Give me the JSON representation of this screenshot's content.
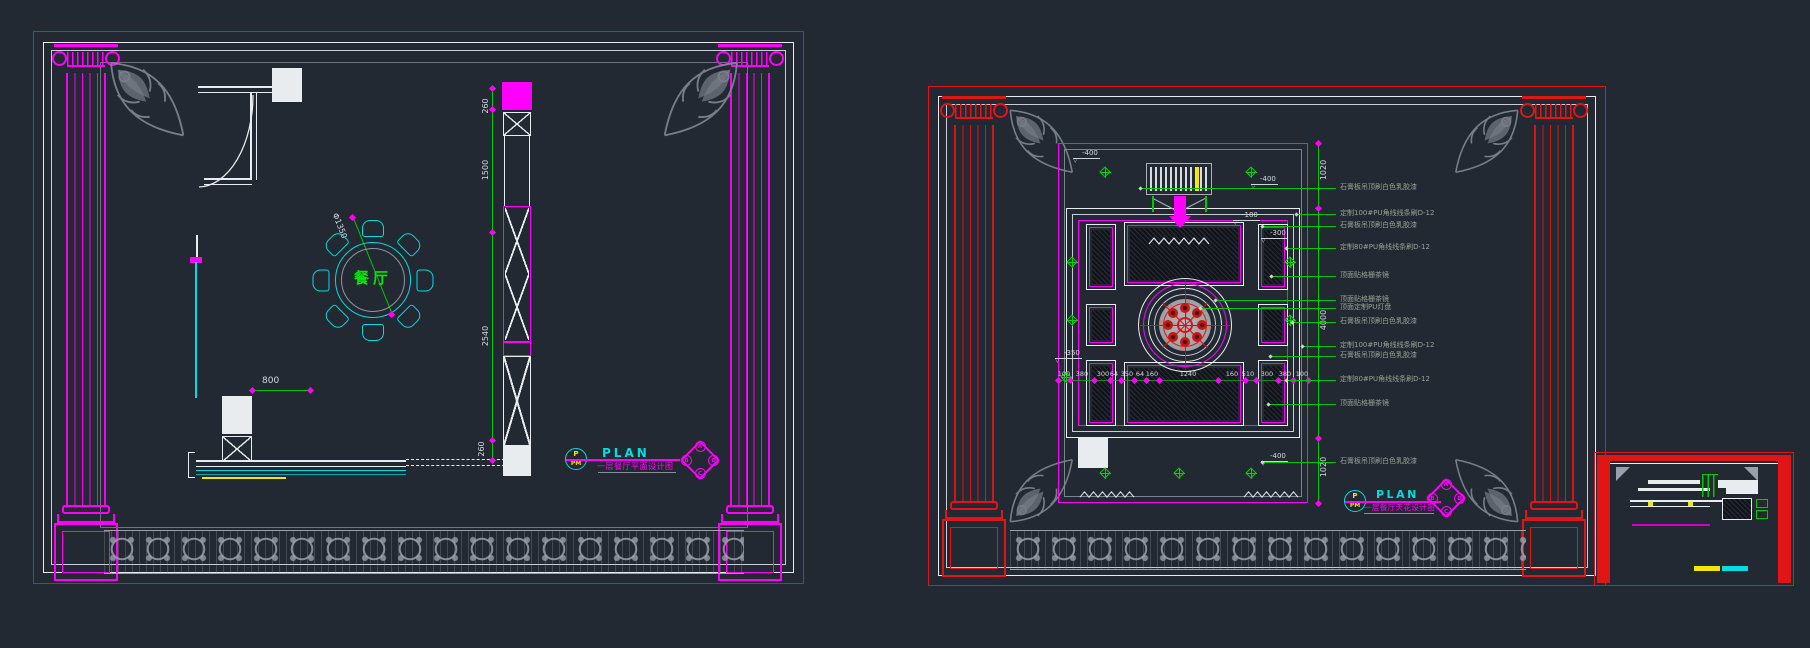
{
  "app": {
    "background": "#232932"
  },
  "colors": {
    "red": "#e01515",
    "magenta": "#ff00ff",
    "cyan": "#00dde0",
    "green": "#00c800",
    "yellow": "#f2e700",
    "white": "#e9ecef",
    "gray": "#98a0ab",
    "annotation_green": "#9aa394"
  },
  "floor_plan": {
    "title": "PLAN",
    "subtitle": "一层餐厅平面设计图",
    "stamp": {
      "top": "P",
      "bottom": "PM"
    },
    "room_label": "餐厅",
    "table_diameter": "Φ1350",
    "door_dim": "800",
    "vertical_dims": [
      "260",
      "1500",
      "2540",
      "260"
    ],
    "logo": {
      "top": "A",
      "left": "B",
      "right": "D",
      "bottom": "C"
    }
  },
  "ceiling_plan": {
    "title": "PLAN",
    "subtitle": "一层餐厅天花设计图",
    "stamp": {
      "top": "P",
      "bottom": "PM"
    },
    "vertical_dims": [
      "1020",
      "4000",
      "1020"
    ],
    "bottom_dims": [
      "100",
      "380",
      "300",
      "64",
      "350",
      "64",
      "160",
      "1240",
      "160",
      "510",
      "300",
      "380",
      "100"
    ],
    "elevation_marks": [
      "-400",
      "-400",
      "-180",
      "-300",
      "-350",
      "-400"
    ],
    "annotations": [
      "石膏板吊顶刷白色乳胶漆",
      "定制100#PU角线线条刷D-12",
      "石膏板吊顶刷白色乳胶漆",
      "定制80#PU角线线条刷D-12",
      "顶面贴格栅茶镜",
      "顶面贴格栅茶镜",
      "顶面定制PU灯盘",
      "石膏板吊顶刷白色乳胶漆",
      "定制100#PU角线线条刷D-12",
      "石膏板吊顶刷白色乳胶漆",
      "定制80#PU角线线条刷D-12",
      "顶面贴格栅茶镜",
      "石膏板吊顶刷白色乳胶漆"
    ],
    "logo": {
      "top": "A",
      "left": "B",
      "right": "D",
      "bottom": "C"
    }
  }
}
